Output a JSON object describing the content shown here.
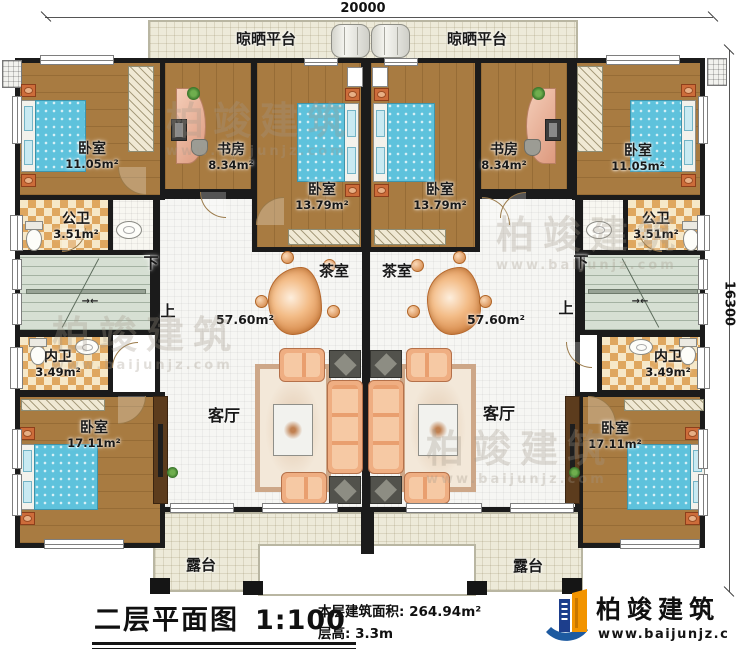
{
  "dimensions": {
    "width_mm": "20000",
    "height_mm": "16300"
  },
  "stairs": {
    "up": "上",
    "down": "下",
    "arrows": "→←"
  },
  "rooms": {
    "drying_platform": {
      "name": "晾晒平台"
    },
    "bedroom_small": {
      "name": "卧室",
      "area": "11.05m²"
    },
    "study": {
      "name": "书房",
      "area": "8.34m²"
    },
    "bedroom_mid": {
      "name": "卧室",
      "area": "13.79m²"
    },
    "public_bath": {
      "name": "公卫",
      "area": "3.51m²"
    },
    "inner_bath": {
      "name": "内卫",
      "area": "3.49m²"
    },
    "bedroom_large": {
      "name": "卧室",
      "area": "17.11m²"
    },
    "tea_room": {
      "name": "茶室"
    },
    "hall_area": "57.60m²",
    "living_room": {
      "name": "客厅"
    },
    "terrace": {
      "name": "露台"
    }
  },
  "title_block": {
    "plan_name": "二层平面图",
    "scale": "1:100",
    "building_area": "本层建筑面积: 264.94m²",
    "floor_height": "层高: 3.3m"
  },
  "brand": {
    "name": "柏竣建筑",
    "website": "www.baijunjz.com"
  },
  "watermark": {
    "name": "柏竣建筑",
    "website": "www.baijunjz.com"
  }
}
